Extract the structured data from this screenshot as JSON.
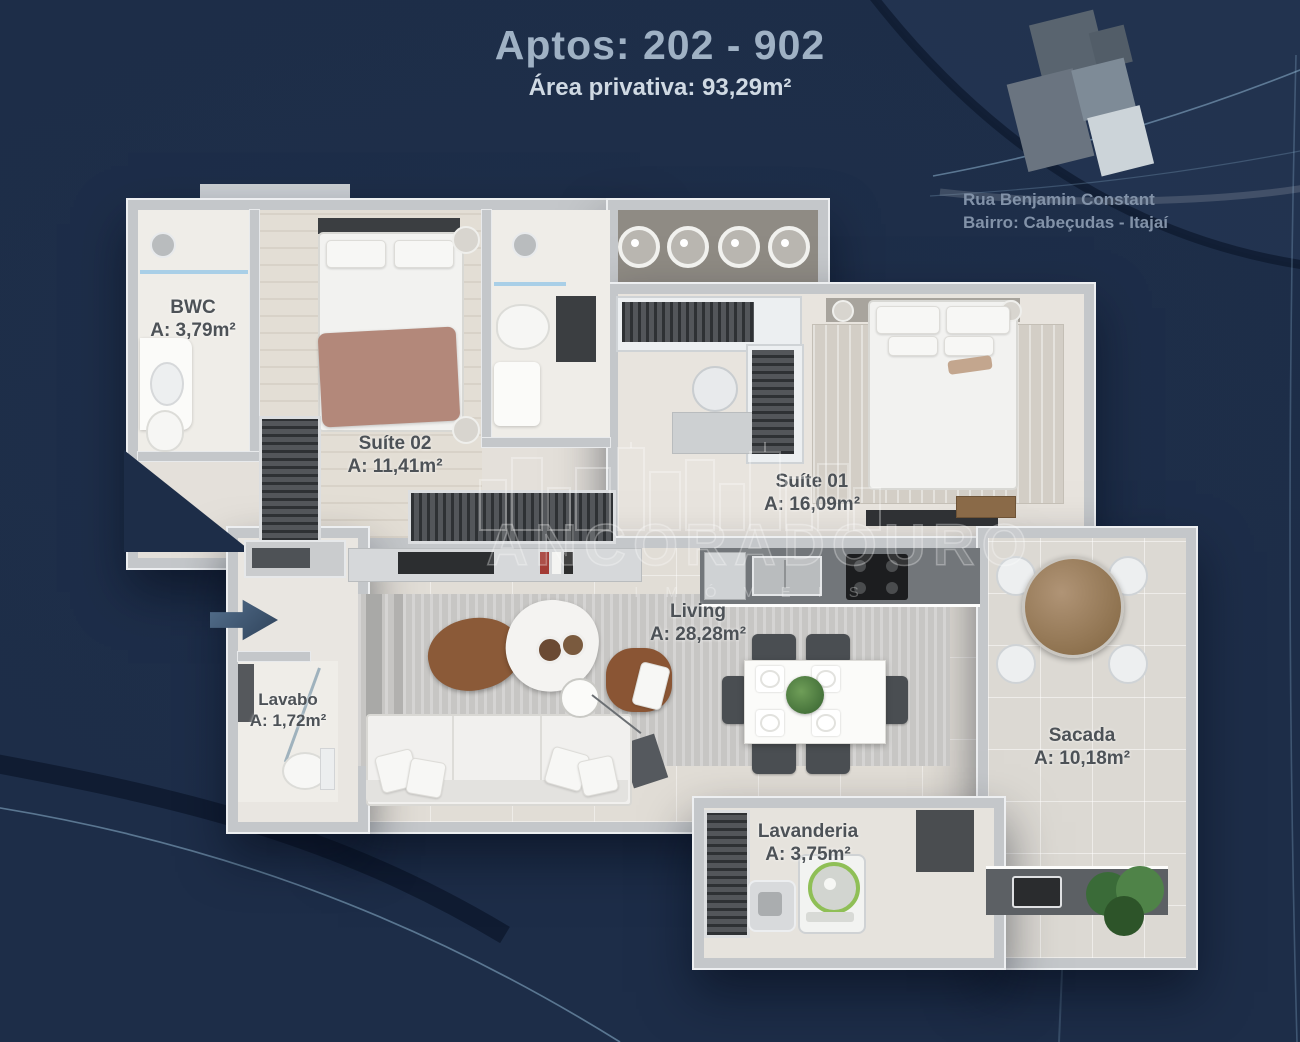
{
  "header": {
    "title": "Aptos: 202 - 902",
    "subtitle": "Área privativa: 93,29m²"
  },
  "location": {
    "line1": "Rua Benjamin Constant",
    "line2": "Bairro: Cabeçudas - Itajaí"
  },
  "watermark": {
    "brand": "ANCORADOURO",
    "tagline": "IMÓVEIS"
  },
  "rooms": [
    {
      "id": "bwc",
      "name": "BWC",
      "area": "A: 3,79m²"
    },
    {
      "id": "suite02",
      "name": "Suíte 02",
      "area": "A: 11,41m²"
    },
    {
      "id": "suite01",
      "name": "Suíte 01",
      "area": "A: 16,09m²"
    },
    {
      "id": "living",
      "name": "Living",
      "area": "A: 28,28m²"
    },
    {
      "id": "lavabo",
      "name": "Lavabo",
      "area": "A: 1,72m²"
    },
    {
      "id": "sacada",
      "name": "Sacada",
      "area": "A: 10,18m²"
    },
    {
      "id": "lavanderia",
      "name": "Lavanderia",
      "area": "A: 3,75m²"
    }
  ],
  "colors": {
    "background": "#1d2d48",
    "wall": "#c4c7ca",
    "floor_light": "#e4e0da",
    "floor_bath": "#efede8",
    "glass_blue": "#a9cfe7",
    "entrance_arrow": "#3d5470",
    "keyplan_highlight": "#ccd4d9",
    "label_text": "#4d5257"
  }
}
